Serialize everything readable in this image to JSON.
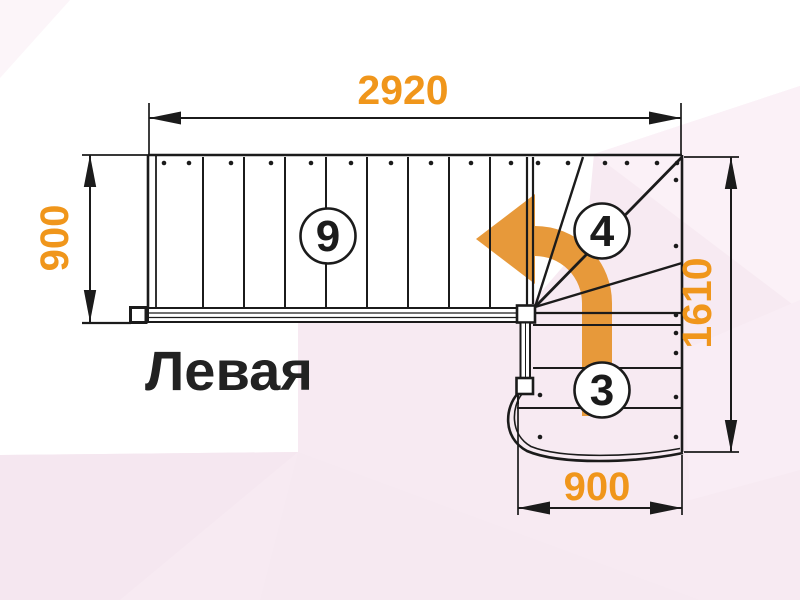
{
  "diagram": {
    "plan_name": "Левая",
    "dimensions": {
      "top_width": "2920",
      "flight_width": "900",
      "right_height": "1610",
      "bottom_width": "900"
    },
    "flights": {
      "straight_steps": "9",
      "winder_steps": "4",
      "lower_steps": "3"
    },
    "colors": {
      "dimension_text": "#F0961B",
      "direction_arrow": "#E7993A",
      "line": "#1B1B1B",
      "background_tint": "#F7EAF2"
    },
    "icons": {
      "direction_arrow": "turn-left-ascent-arrow"
    }
  }
}
